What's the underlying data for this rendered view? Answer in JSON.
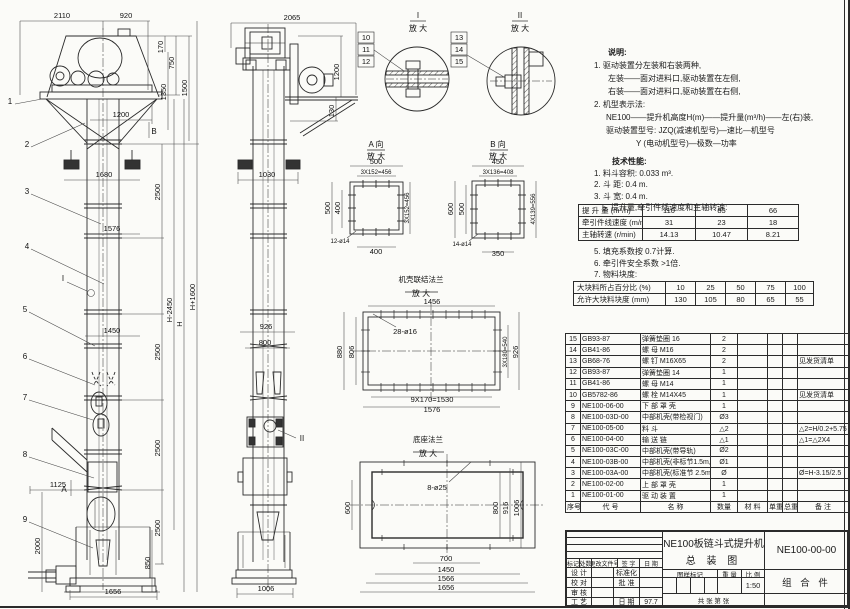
{
  "sheet": {
    "line_color": "#2b2b2b",
    "bg_color": "#fbfbf8"
  },
  "front_view": {
    "balloons": [
      "1",
      "2",
      "3",
      "4",
      "5",
      "6",
      "7",
      "8",
      "9"
    ],
    "markers": {
      "a": "A",
      "b": "B",
      "i": "I"
    },
    "dims": [
      "2110",
      "920",
      "170",
      "750",
      "1350",
      "1500",
      "1200",
      "1680",
      "1576",
      "1450",
      "1125",
      "2000",
      "850",
      "1656",
      "2500",
      "2500",
      "2500",
      "2500",
      "H-2450",
      "H",
      "H+1600"
    ]
  },
  "side_view": {
    "marker": "II",
    "dims": [
      "2065",
      "1200",
      "130",
      "1030",
      "926",
      "800",
      "1006"
    ]
  },
  "detail_i": {
    "label": "I",
    "sub": "放 大",
    "balloons": [
      "10",
      "11",
      "12"
    ]
  },
  "detail_ii": {
    "label": "II",
    "sub": "放 大",
    "balloons": [
      "13",
      "14",
      "15"
    ]
  },
  "view_a": {
    "label": "A 向",
    "sub": "放 大",
    "dims": [
      "500",
      "3X152=456",
      "500",
      "400",
      "3X152=456",
      "12-ø14",
      "400"
    ]
  },
  "view_b": {
    "label": "B 向",
    "sub": "放 大",
    "dims": [
      "450",
      "3X136=408",
      "600",
      "500",
      "4X139=556",
      "14-ø14",
      "350"
    ]
  },
  "flange_view": {
    "label": "机壳联结法兰",
    "sub": "放 大",
    "dims": [
      "1456",
      "28-ø16",
      "880",
      "806",
      "3X180=540",
      "926",
      "9X170=1530",
      "1576"
    ]
  },
  "base_view": {
    "label": "底座法兰",
    "sub": "放 大",
    "dims": [
      "8-ø25",
      "600",
      "800",
      "916",
      "1006",
      "700",
      "1450",
      "1566",
      "1656"
    ]
  },
  "notes": {
    "heading": "说明:",
    "lines": [
      "1. 驱动装置分左装和右装两种,",
      "左装——面对进料口,驱动装置在左侧,",
      "右装——面对进料口,驱动装置在右侧,",
      "2. 机型表示法:",
      "NE100——提升机高度H(m)——提升量(m³/h)——左(右)装,",
      "驱动装置型号: JZQ(减速机型号)—速比—机型号",
      "Y (电动机型号)—极数—功率"
    ]
  },
  "specs": {
    "heading": "技术性能:",
    "lines": [
      "1. 料斗容积: 0.033 m³.",
      "2. 斗  距: 0.4 m.",
      "3. 斗  宽: 0.4 m.",
      "5. 提升量,牵引件线速度和主轴转速:"
    ],
    "notes2": [
      "5. 填充系数按 0.7计算.",
      "6. 牵引件安全系数 >1倍.",
      "7. 物料块度:"
    ]
  },
  "speed_table": {
    "rows": [
      [
        "提 升 量  (m³/h)",
        "110",
        "85",
        "66"
      ],
      [
        "牵引件线速度 (m/min)",
        "31",
        "23",
        "18"
      ],
      [
        "主轴转速 (r/min)",
        "14.13",
        "10.47",
        "8.21"
      ]
    ]
  },
  "block_table": {
    "rows": [
      [
        "大块料所占百分比 (%)",
        "10",
        "25",
        "50",
        "75",
        "100"
      ],
      [
        "允许大块料块度 (mm)",
        "130",
        "105",
        "80",
        "65",
        "55"
      ]
    ]
  },
  "parts_list": {
    "headers": [
      "序号",
      "代  号",
      "名    称",
      "数量",
      "材  料",
      "单重",
      "总重",
      "备  注"
    ],
    "rows": [
      [
        "15",
        "GB93-87",
        "弹簧垫圈 16",
        "2",
        "",
        "",
        "",
        ""
      ],
      [
        "14",
        "GB41-86",
        "螺 母  M16",
        "2",
        "",
        "",
        "",
        ""
      ],
      [
        "13",
        "GB68-76",
        "螺 钉  M16X65",
        "2",
        "",
        "",
        "",
        "见发货清单"
      ],
      [
        "12",
        "GB93-87",
        "弹簧垫圈 14",
        "1",
        "",
        "",
        "",
        ""
      ],
      [
        "11",
        "GB41-86",
        "螺 母  M14",
        "1",
        "",
        "",
        "",
        ""
      ],
      [
        "10",
        "GB5782-86",
        "螺 栓  M14X45",
        "1",
        "",
        "",
        "",
        "见发货清单"
      ],
      [
        "9",
        "NE100-06-00",
        "下 部 罩 壳",
        "1",
        "",
        "",
        "",
        ""
      ],
      [
        "8",
        "NE100-03D-00",
        "中部机壳(带检视门)",
        "Ø3",
        "",
        "",
        "",
        ""
      ],
      [
        "7",
        "NE100-05-00",
        "料  斗",
        "△2",
        "",
        "",
        "",
        "△2=H/0.2+5.75"
      ],
      [
        "6",
        "NE100-04-00",
        "输 送 链",
        "△1",
        "",
        "",
        "",
        "△1=△2X4"
      ],
      [
        "5",
        "NE100-03C-00",
        "中部机壳(带导轨)",
        "Ø2",
        "",
        "",
        "",
        ""
      ],
      [
        "4",
        "NE100-03B-00",
        "中部机壳(非标节1.5m,1m)",
        "Ø1",
        "",
        "",
        "",
        ""
      ],
      [
        "3",
        "NE100-03A-00",
        "中部机壳(标准节 2.5m)",
        "Ø",
        "",
        "",
        "",
        "Ø=H-3.15/2.5"
      ],
      [
        "2",
        "NE100-02-00",
        "上 部 罩 壳",
        "1",
        "",
        "",
        "",
        ""
      ],
      [
        "1",
        "NE100-01-00",
        "驱 动 装 置",
        "1",
        "",
        "",
        "",
        ""
      ]
    ]
  },
  "title_block": {
    "product": "NE100板链斗式提升机",
    "sheet_name": "总  装  图",
    "drawing_no": "NE100-00-00",
    "assembly": "组 合 件",
    "rev_headers": [
      "标记",
      "处数",
      "更改文件号",
      "签 字",
      "日 期"
    ],
    "role_rows": [
      [
        "设 计",
        "标准化",
        ""
      ],
      [
        "校 对",
        "批 准",
        ""
      ],
      [
        "审 核",
        "",
        ""
      ],
      [
        "工 艺",
        "日 期",
        "97.7"
      ]
    ],
    "stamp_headers": [
      "图样标记",
      "重 量",
      "比 例"
    ],
    "scale": "1:50",
    "sheet_info": "共  张  第  张"
  }
}
